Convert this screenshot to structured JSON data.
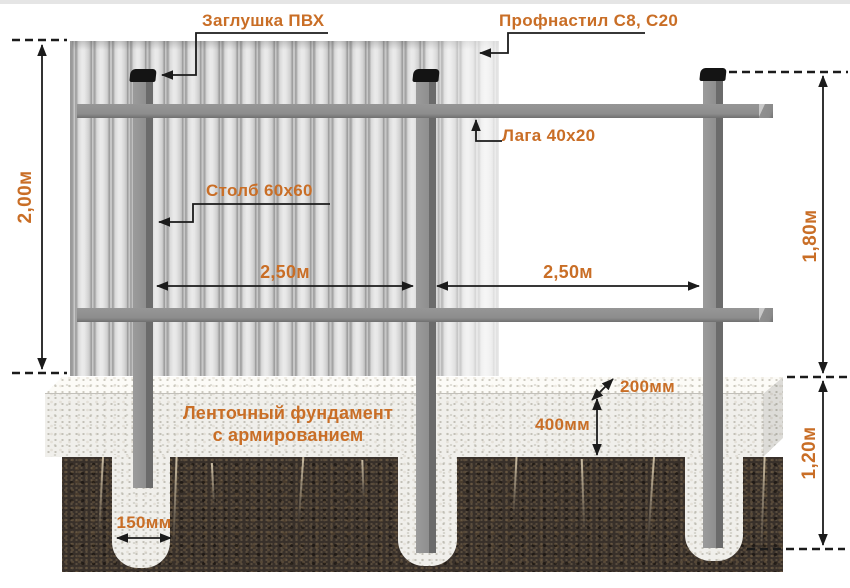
{
  "diagram": {
    "labels": {
      "cap": "Заглушка ПВХ",
      "sheet": "Профнастил С8, С20",
      "rail": "Лага 40x20",
      "post": "Столб 60x60",
      "foundation_line1": "Ленточный фундамент",
      "foundation_line2": "с армированием"
    },
    "dimensions": {
      "total_height": "2,00м",
      "fence_height": "1,80м",
      "foundation_depth": "1,20м",
      "span_left": "2,50м",
      "span_right": "2,50м",
      "pile_width": "150мм",
      "foundation_top_width": "200мм",
      "foundation_face_height": "400мм"
    },
    "colors": {
      "accent_text": "#c96e26",
      "annotation_line": "#1b1b1b",
      "post_gray": "#8d8d8d",
      "cap_black": "#141414",
      "sheet_gray": "#d9d9d9",
      "concrete": "#f0efeb",
      "soil_brown": "#38302a"
    }
  }
}
